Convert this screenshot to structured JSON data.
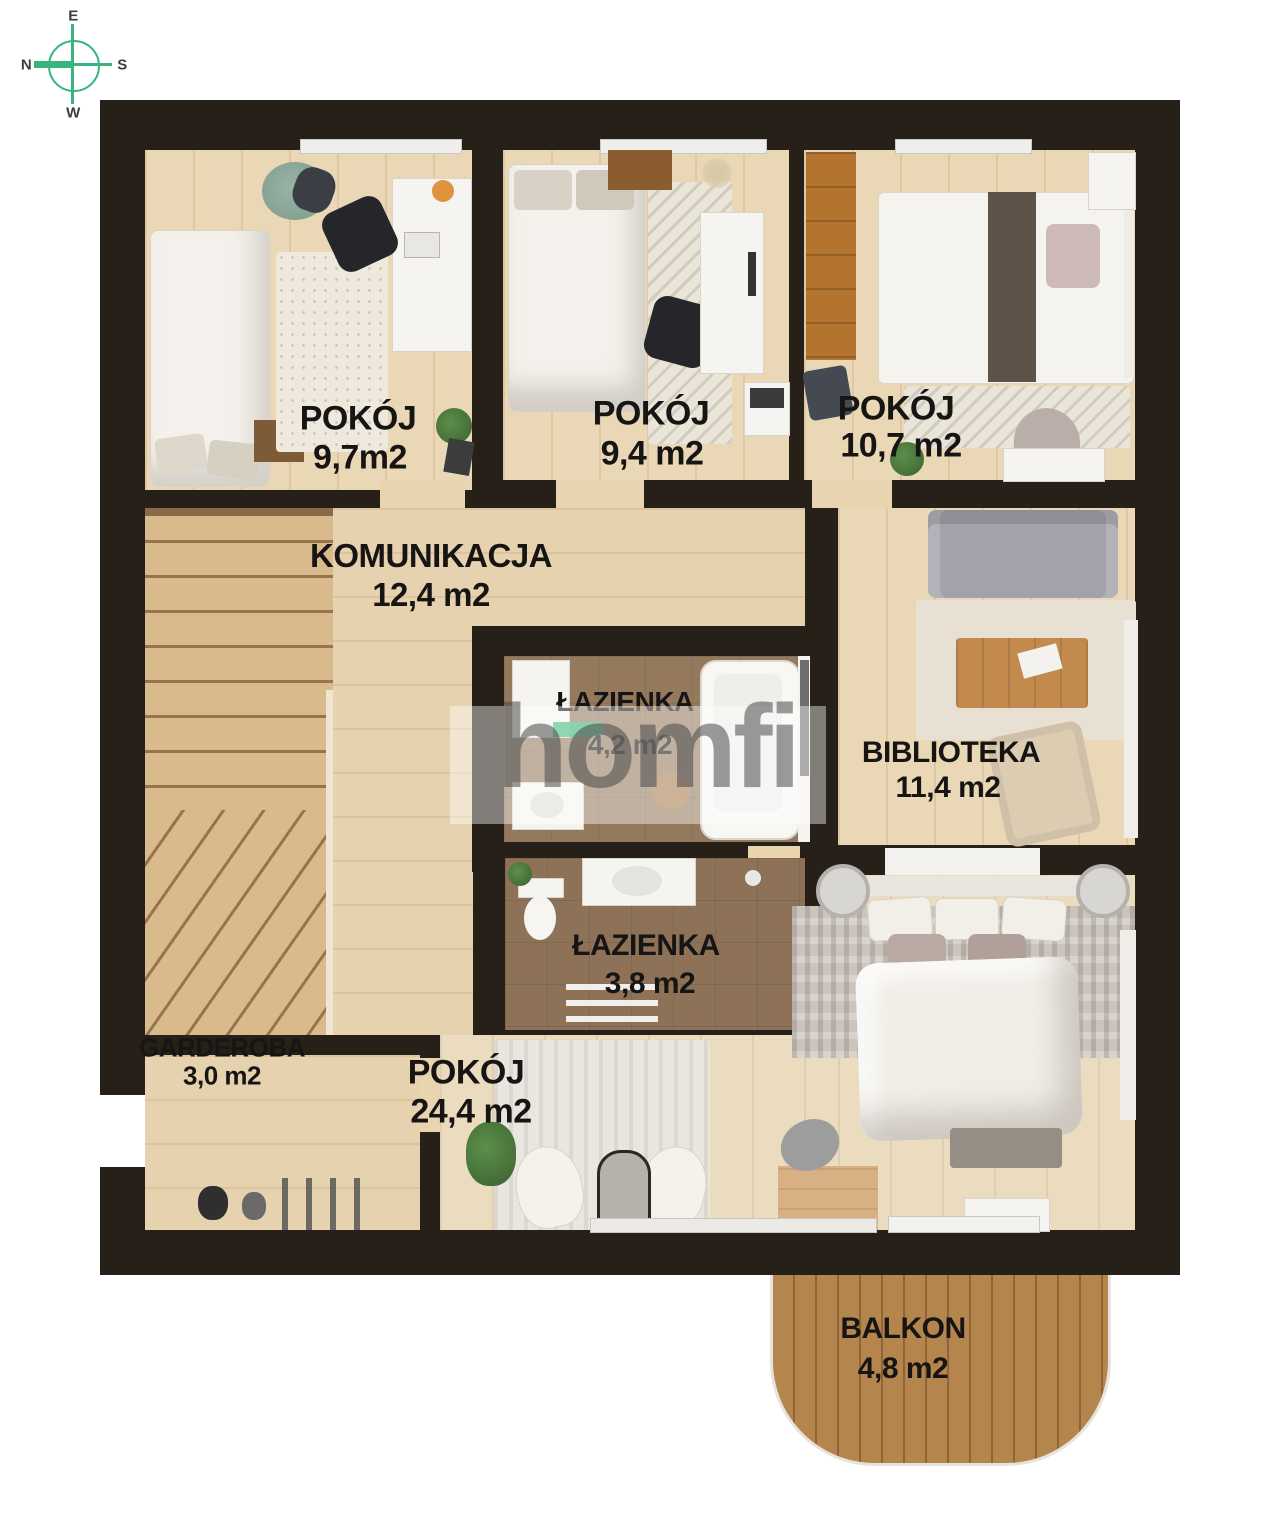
{
  "compass": {
    "e": "E",
    "s": "S",
    "w": "W",
    "n": "N"
  },
  "watermark": {
    "brand": "homfi"
  },
  "colors": {
    "wall": "#272019",
    "accent_green": "#34b474",
    "label": "#161514"
  },
  "rooms": [
    {
      "name": "POKÓJ",
      "area": "9,7m2"
    },
    {
      "name": "POKÓJ",
      "area": "9,4 m2"
    },
    {
      "name": "POKÓJ",
      "area": "10,7 m2"
    },
    {
      "name": "KOMUNIKACJA",
      "area": "12,4 m2"
    },
    {
      "name": "ŁAZIENKA",
      "area": "4,2 m2"
    },
    {
      "name": "BIBLIOTEKA",
      "area": "11,4 m2"
    },
    {
      "name": "ŁAZIENKA",
      "area": "3,8 m2"
    },
    {
      "name": "GARDEROBA",
      "area": "3,0 m2"
    },
    {
      "name": "POKÓJ",
      "area": "24,4 m2"
    },
    {
      "name": "BALKON",
      "area": "4,8 m2"
    }
  ]
}
